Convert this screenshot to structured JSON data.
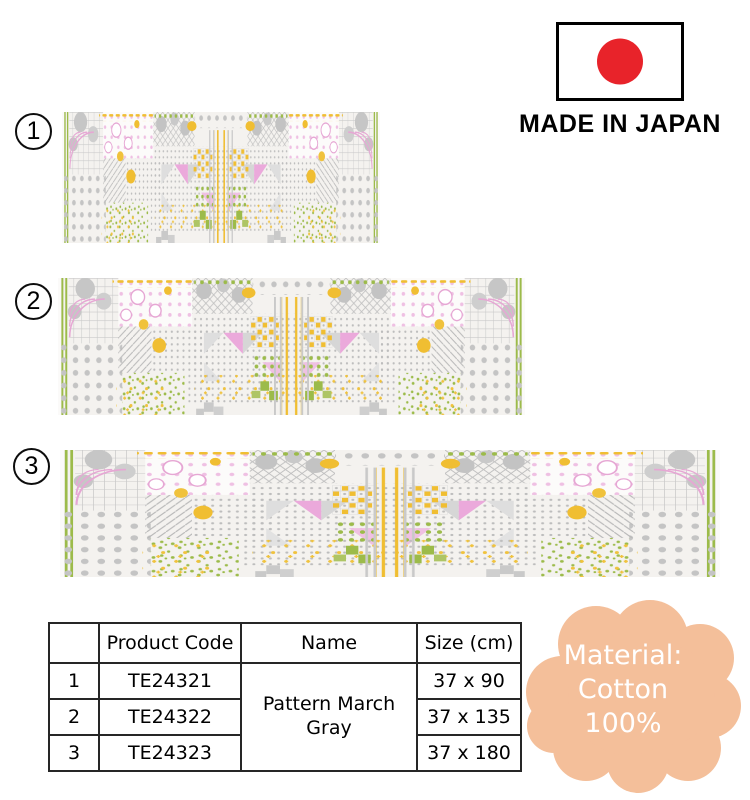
{
  "origin": {
    "label": "MADE IN JAPAN",
    "flag_circle_color": "#e8232a",
    "flag_border_color": "#000000"
  },
  "products": [
    {
      "number": "1"
    },
    {
      "number": "2"
    },
    {
      "number": "3"
    }
  ],
  "fabric_palette": {
    "background": "#f4f2ef",
    "gray": "#bdbdbd",
    "yellow": "#f0be32",
    "green": "#9cbb4a",
    "pink": "#eba9db"
  },
  "table": {
    "headers": {
      "index": "",
      "code": "Product Code",
      "name": "Name",
      "size": "Size (cm)"
    },
    "name": "Pattern March Gray",
    "rows": [
      {
        "no": "1",
        "code": "TE24321",
        "size": "37 x 90"
      },
      {
        "no": "2",
        "code": "TE24322",
        "size": "37 x 135"
      },
      {
        "no": "3",
        "code": "TE24323",
        "size": "37 x 180"
      }
    ]
  },
  "material": {
    "bg_color": "#f4bf9a",
    "text_color": "#ffffff",
    "lines": [
      "Material:",
      "Cotton",
      "100%"
    ]
  }
}
